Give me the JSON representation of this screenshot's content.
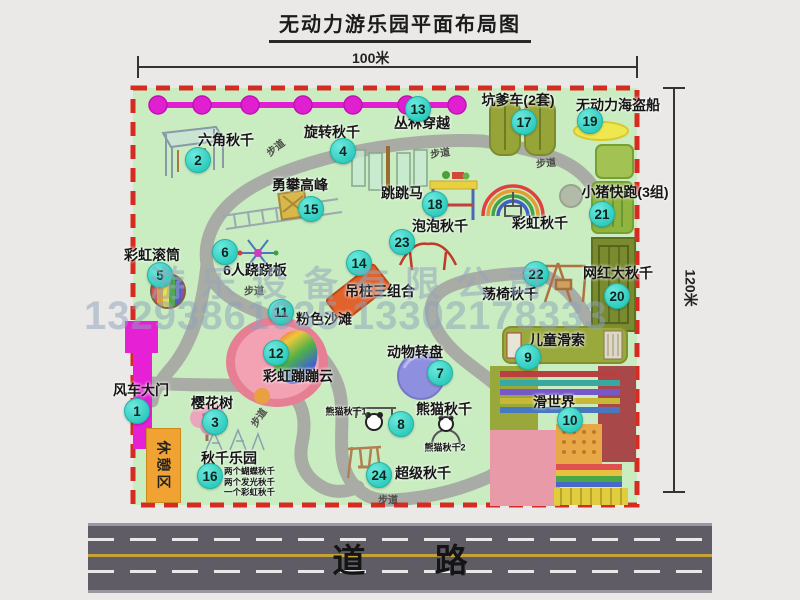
{
  "title": "无动力游乐园平面布局图",
  "dimension_labels": {
    "top": "100米",
    "right": "120米"
  },
  "road": {
    "label": "道 路"
  },
  "watermark": {
    "company": "游乐设备有限公司",
    "phones": "13293861635 13302178333"
  },
  "rest_area": {
    "label": "休憩区"
  },
  "walkway_label_text": "步道",
  "colors": {
    "park_green": "#c9ecc1",
    "boundary_red": "#d62b20",
    "badge_teal": "#2fcdbf",
    "chain_magenta": "#e01fd0",
    "gate_magenta": "#e520d5",
    "rest_orange": "#f0a232",
    "road_gray": "#5f5c66",
    "pirate_yellow": "#eee84e",
    "carousel_purple": "#8f8fdf",
    "beach_pink": "#ee8fa2"
  },
  "attractions": [
    {
      "id": "windmill-gate",
      "num": "1",
      "name": "风车大门",
      "icon": "magenta-gate",
      "label_pos": [
        141,
        390
      ],
      "badge_pos": [
        137,
        411
      ]
    },
    {
      "id": "hexagon-swing",
      "num": "2",
      "name": "六角秋千",
      "icon": "hexagon-frame",
      "label_pos": [
        226,
        140
      ],
      "badge_pos": [
        198,
        160
      ]
    },
    {
      "id": "cherry-tree",
      "num": "3",
      "name": "樱花树",
      "icon": "pink-tree",
      "label_pos": [
        212,
        403
      ],
      "badge_pos": [
        215,
        422
      ]
    },
    {
      "id": "rotating-swing",
      "num": "4",
      "name": "旋转秋千",
      "icon": "carousel-swing",
      "label_pos": [
        332,
        132
      ],
      "badge_pos": [
        343,
        151
      ]
    },
    {
      "id": "rainbow-roller",
      "num": "5",
      "name": "彩虹滚筒",
      "icon": "striped-drum",
      "label_pos": [
        152,
        255
      ],
      "badge_pos": [
        160,
        275
      ]
    },
    {
      "id": "six-seesaw",
      "num": "6",
      "name": "6人跷跷板",
      "icon": "spinner-seesaw",
      "label_pos": [
        255,
        270
      ],
      "badge_pos": [
        225,
        252
      ]
    },
    {
      "id": "animal-carousel",
      "num": "7",
      "name": "动物转盘",
      "icon": "purple-disc",
      "label_pos": [
        415,
        352
      ],
      "badge_pos": [
        440,
        373
      ]
    },
    {
      "id": "panda-swing",
      "num": "8",
      "name": "熊猫秋千",
      "icon": "panda-frames",
      "label_pos": [
        444,
        409
      ],
      "badge_pos": [
        401,
        424
      ]
    },
    {
      "id": "kids-zipline",
      "num": "9",
      "name": "儿童滑索",
      "icon": "zipline-track",
      "label_pos": [
        557,
        340
      ],
      "badge_pos": [
        528,
        357
      ]
    },
    {
      "id": "slide-world",
      "num": "10",
      "name": "滑世界",
      "icon": "rainbow-slides",
      "label_pos": [
        554,
        402
      ],
      "badge_pos": [
        570,
        420
      ]
    },
    {
      "id": "pink-beach",
      "num": "11",
      "name": "粉色沙滩",
      "icon": "pink-blob",
      "label_pos": [
        324,
        319
      ],
      "badge_pos": [
        281,
        312
      ]
    },
    {
      "id": "rainbow-bounce-cloud",
      "num": "12",
      "name": "彩虹蹦蹦云",
      "icon": "rainbow-blob",
      "label_pos": [
        298,
        376
      ],
      "badge_pos": [
        276,
        353
      ]
    },
    {
      "id": "jungle-crossing",
      "num": "13",
      "name": "丛林穿越",
      "icon": "magenta-chain",
      "label_pos": [
        422,
        123
      ],
      "badge_pos": [
        418,
        109
      ]
    },
    {
      "id": "hanging-piles",
      "num": "14",
      "name": "吊桩三组合",
      "icon": "orange-ramp",
      "label_pos": [
        380,
        291
      ],
      "badge_pos": [
        359,
        263
      ]
    },
    {
      "id": "climbing-peak",
      "num": "15",
      "name": "勇攀高峰",
      "icon": "climb-ladder",
      "label_pos": [
        300,
        185
      ],
      "badge_pos": [
        311,
        209
      ]
    },
    {
      "id": "swing-park",
      "num": "16",
      "name": "秋千乐园",
      "icon": "swing-frames",
      "label_pos": [
        229,
        458
      ],
      "badge_pos": [
        210,
        476
      ],
      "notes": [
        "两个蝴蝶秋千",
        "两个发光秋千",
        "一个彩虹秋千"
      ],
      "notes_pos": [
        224,
        465
      ]
    },
    {
      "id": "kengdie-car",
      "num": "17",
      "name": "坑爹车(2套)",
      "icon": "green-car-lanes",
      "label_pos": [
        518,
        100
      ],
      "badge_pos": [
        524,
        122
      ]
    },
    {
      "id": "jumping-horse",
      "num": "18",
      "name": "跳跳马",
      "icon": "colorful-table",
      "label_pos": [
        402,
        193
      ],
      "badge_pos": [
        435,
        204
      ]
    },
    {
      "id": "pirate-ship",
      "num": "19",
      "name": "无动力海盗船",
      "icon": "yellow-boat",
      "label_pos": [
        618,
        105
      ],
      "badge_pos": [
        590,
        121
      ]
    },
    {
      "id": "big-swing",
      "num": "20",
      "name": "网红大秋千",
      "icon": "olive-grid",
      "label_pos": [
        618,
        273
      ],
      "badge_pos": [
        617,
        296
      ]
    },
    {
      "id": "piggy-run",
      "num": "21",
      "name": "小猪快跑(3组)",
      "icon": "green-lanes",
      "label_pos": [
        625,
        192
      ],
      "badge_pos": [
        602,
        214
      ]
    },
    {
      "id": "swing-chair",
      "num": "22",
      "name": "荡椅秋千",
      "icon": "a-frame-chair",
      "label_pos": [
        510,
        294
      ],
      "badge_pos": [
        536,
        274
      ]
    },
    {
      "id": "bubble-swing",
      "num": "23",
      "name": "泡泡秋千",
      "icon": "red-curve-swing",
      "label_pos": [
        440,
        226
      ],
      "badge_pos": [
        402,
        242
      ]
    },
    {
      "id": "super-swing",
      "num": "24",
      "name": "超级秋千",
      "icon": "tall-swing-frame",
      "label_pos": [
        423,
        473
      ],
      "badge_pos": [
        379,
        475
      ]
    },
    {
      "id": "rainbow-swing",
      "num": null,
      "name": "彩虹秋千",
      "icon": "rainbow-arcs",
      "label_pos": [
        540,
        223
      ],
      "badge_pos": null
    }
  ],
  "sub_labels": [
    {
      "id": "panda-swing-1",
      "text": "熊猫秋千1",
      "pos": [
        346,
        411
      ]
    },
    {
      "id": "panda-swing-2",
      "text": "熊猫秋千2",
      "pos": [
        445,
        447
      ]
    }
  ],
  "walkway_label_positions": [
    {
      "pos": [
        275,
        147
      ],
      "rot": -38
    },
    {
      "pos": [
        440,
        152
      ],
      "rot": -8
    },
    {
      "pos": [
        546,
        162
      ],
      "rot": -5
    },
    {
      "pos": [
        254,
        290
      ],
      "rot": 0
    },
    {
      "pos": [
        258,
        417
      ],
      "rot": -55
    },
    {
      "pos": [
        388,
        499
      ],
      "rot": 0
    }
  ]
}
